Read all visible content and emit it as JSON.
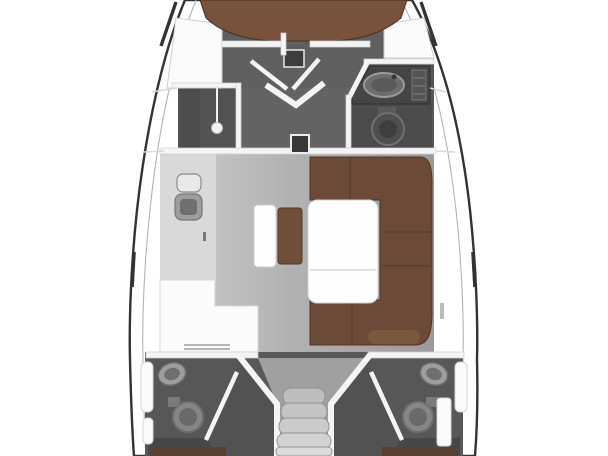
{
  "meta": {
    "title": "Sailing yacht interior floor plan, top view (bow up, bow and stern cropped)",
    "diagram_type": "boat-floor-plan"
  },
  "colors": {
    "background": "#ffffff",
    "hull_outline": "#333333",
    "inner_deck_line": "#b3b3b3",
    "deck_white": "#ffffff",
    "wall_white": "#f4f4f4",
    "cabin_floor": "#5f5f5f",
    "shower_floor": "#525252",
    "shower_bench": "#4d4d4d",
    "corridor_floor": "#636363",
    "head_floor": "#575757",
    "head_floor_dark": "#4c4c4c",
    "galley_counter": "#d9d9d9",
    "counter_white": "#fbfbfb",
    "locker_white": "#fafafa",
    "berth_brown": "#77523c",
    "settee_brown": "#6b4b37",
    "bench_brown": "#6f4f3a",
    "bed_strip_brown": "#5a4030",
    "wood_edge": "#503524",
    "table_white": "#fefefe",
    "fixture_dark": "#454545",
    "sink_oval": "#6d6d6d",
    "sink_oval_inner": "#5a5a5a",
    "sink_basin": "#9d9d9d",
    "sink_basin_inner": "#6f6f6f",
    "sink_top": "#e9e9e9",
    "toilet_fwd": "#4f4f4f",
    "toilet_fwd_inner": "#3f3f3f",
    "toilet_aft": "#868686",
    "toilet_aft_inner": "#6a6a6a",
    "aft_base": "#585858",
    "aft_passage": "#525252",
    "aft_corner": "#474747",
    "funnel_floor": "#a0a0a0",
    "stair_1": "#bdbdbd",
    "stair_2": "#c4c4c4",
    "stair_3": "#cbcbcb",
    "stair_4": "#d2d2d2",
    "stair_5": "#dadada",
    "mast_dark": "#383838",
    "pendant_white": "#f2f2f2",
    "hatch_dark": "#3d3d3d",
    "panel_striped": "#555555",
    "deck_mark": "#bbbbbb"
  },
  "areas": [
    {
      "name": "bow-berth",
      "label": "v-berth-double-bed"
    },
    {
      "name": "forward-cabin",
      "label": "forward-cabin-floor"
    },
    {
      "name": "shower-room",
      "label": "forward-shower-compartment"
    },
    {
      "name": "forward-head",
      "label": "forward-bathroom-sink-toilet"
    },
    {
      "name": "saloon",
      "label": "saloon-with-u-settee-and-table"
    },
    {
      "name": "galley",
      "label": "galley-with-twin-sink"
    },
    {
      "name": "nav-station",
      "label": "chart-table-counter"
    },
    {
      "name": "companionway",
      "label": "companionway-steps"
    },
    {
      "name": "port-aft-head",
      "label": "port-aft-bathroom"
    },
    {
      "name": "starboard-aft-head",
      "label": "starboard-aft-bathroom"
    },
    {
      "name": "port-aft-cabin",
      "label": "port-aft-cabin-berth"
    },
    {
      "name": "starboard-aft-cabin",
      "label": "starboard-aft-cabin-berth"
    }
  ]
}
